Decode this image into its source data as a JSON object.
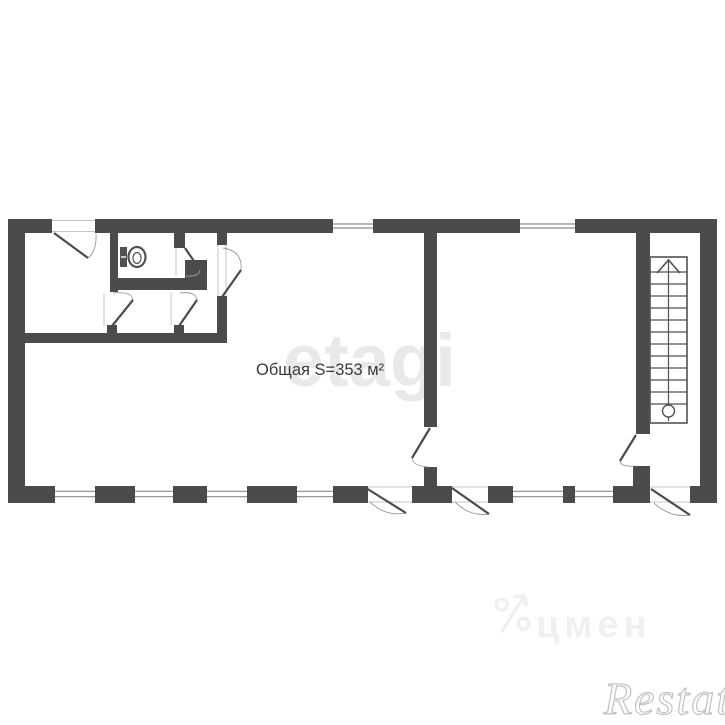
{
  "labels": {
    "area": "Общая S=353 м²"
  },
  "watermarks": {
    "etagi": "etagi",
    "cian": "цмен",
    "restate": "Restate"
  },
  "colors": {
    "wall": "#4b4b4b",
    "fixture": "#525252",
    "glazing": "#8c8c8c",
    "arc": "#9a9a9a",
    "thin": "#c4c4c4",
    "watermark_light": "#f0f0f0"
  },
  "plan": {
    "walls": [
      {
        "name": "top-wall-a",
        "r": [
          8,
          219,
          44,
          14
        ]
      },
      {
        "name": "top-wall-b",
        "r": [
          95,
          219,
          238,
          14
        ]
      },
      {
        "name": "top-wall-c",
        "r": [
          373,
          219,
          147,
          14
        ]
      },
      {
        "name": "top-wall-d",
        "r": [
          575,
          219,
          142,
          14
        ]
      },
      {
        "name": "left-wall",
        "r": [
          8,
          219,
          17,
          284
        ]
      },
      {
        "name": "right-wall",
        "r": [
          700,
          219,
          17,
          284
        ]
      },
      {
        "name": "bottom-wall-a",
        "r": [
          8,
          486,
          47,
          17
        ]
      },
      {
        "name": "bottom-wall-b",
        "r": [
          95,
          486,
          40,
          17
        ]
      },
      {
        "name": "bottom-wall-c",
        "r": [
          173,
          486,
          34,
          17
        ]
      },
      {
        "name": "bottom-wall-d",
        "r": [
          247,
          486,
          50,
          17
        ]
      },
      {
        "name": "bottom-wall-e",
        "r": [
          333,
          486,
          35,
          17
        ]
      },
      {
        "name": "bottom-wall-f",
        "r": [
          412,
          486,
          40,
          17
        ]
      },
      {
        "name": "bottom-wall-g",
        "r": [
          488,
          486,
          25,
          17
        ]
      },
      {
        "name": "bottom-wall-mullion",
        "r": [
          563,
          486,
          12,
          17
        ]
      },
      {
        "name": "bottom-wall-h",
        "r": [
          613,
          486,
          37,
          17
        ]
      },
      {
        "name": "bottom-wall-i",
        "r": [
          690,
          486,
          27,
          17
        ]
      },
      {
        "name": "middle-partition",
        "r": [
          424,
          233,
          13,
          194
        ]
      },
      {
        "name": "middle-partition-stub",
        "r": [
          424,
          467,
          13,
          19
        ]
      },
      {
        "name": "right-partition",
        "r": [
          636,
          233,
          14,
          201
        ]
      },
      {
        "name": "right-partition-stub",
        "r": [
          633,
          466,
          17,
          20
        ]
      },
      {
        "name": "toilet-left-wall",
        "r": [
          110,
          233,
          8,
          59
        ]
      },
      {
        "name": "toilet-bottom-wall",
        "r": [
          110,
          278,
          75,
          12
        ]
      },
      {
        "name": "toilet-right-stub",
        "r": [
          174,
          233,
          11,
          15
        ]
      },
      {
        "name": "cluster-mid-chunk",
        "r": [
          185,
          260,
          22,
          30
        ]
      },
      {
        "name": "cluster-right-stub-top",
        "r": [
          217,
          233,
          10,
          12
        ]
      },
      {
        "name": "cluster-right-wall",
        "r": [
          217,
          296,
          10,
          47
        ]
      },
      {
        "name": "corridor-wall",
        "r": [
          8,
          333,
          219,
          10
        ]
      },
      {
        "name": "corridor-stub-1",
        "r": [
          107,
          325,
          10,
          9
        ]
      },
      {
        "name": "corridor-stub-2",
        "r": [
          174,
          325,
          10,
          9
        ]
      }
    ],
    "windows": [
      {
        "name": "window-top-1",
        "r": [
          333,
          220,
          40,
          12
        ]
      },
      {
        "name": "window-top-2",
        "r": [
          520,
          220,
          55,
          12
        ]
      },
      {
        "name": "window-bottom-1",
        "r": [
          55,
          486,
          40,
          16
        ]
      },
      {
        "name": "window-bottom-2",
        "r": [
          135,
          486,
          38,
          16
        ]
      },
      {
        "name": "window-bottom-3",
        "r": [
          207,
          486,
          40,
          16
        ]
      },
      {
        "name": "window-bottom-4",
        "r": [
          297,
          486,
          36,
          16
        ]
      },
      {
        "name": "window-bottom-5",
        "r": [
          513,
          486,
          50,
          16
        ]
      },
      {
        "name": "window-bottom-6",
        "r": [
          575,
          486,
          38,
          16
        ]
      }
    ],
    "doors": [
      {
        "name": "entrance-door",
        "leaf": [
          54,
          233,
          88,
          258
        ],
        "arc": "M88,258 Q97,251 96,234"
      },
      {
        "name": "toilet-door",
        "leaf": [
          185,
          248,
          200,
          270
        ],
        "arc": "M200,270 Q199,277 186,276"
      },
      {
        "name": "hall-door",
        "leaf": [
          222,
          297,
          241,
          270
        ],
        "arc": "M241,270 Q243,251 223,248"
      },
      {
        "name": "corridor-door-1",
        "leaf": [
          112,
          326,
          133,
          300
        ],
        "arc": "M133,300 Q132,291 113,293"
      },
      {
        "name": "corridor-door-2",
        "leaf": [
          179,
          326,
          197,
          300
        ],
        "arc": "M197,300 Q196,291 180,293"
      },
      {
        "name": "mid-room-door",
        "leaf": [
          430,
          428,
          412,
          458
        ],
        "arc": "M412,458 Q413,466 428,467"
      },
      {
        "name": "stair-hall-door",
        "leaf": [
          636,
          435,
          620,
          461
        ],
        "arc": "M620,461 Q621,467 634,466"
      },
      {
        "name": "exit-door-1",
        "leaf": [
          366,
          488,
          406,
          513
        ],
        "arc": "M370,502 Q386,517 406,513"
      },
      {
        "name": "exit-door-2",
        "leaf": [
          452,
          488,
          489,
          514
        ],
        "arc": "M455,502 Q470,517 489,514"
      },
      {
        "name": "exit-door-3",
        "leaf": [
          651,
          489,
          690,
          515
        ],
        "arc": "M654,503 Q670,518 690,515"
      }
    ],
    "thin_lines": [
      [
        52,
        220.5,
        95,
        220.5
      ],
      [
        52,
        231.5,
        95,
        231.5
      ],
      [
        104,
        293,
        104,
        326
      ],
      [
        171,
        293,
        171,
        326
      ],
      [
        218,
        245,
        218,
        296
      ],
      [
        226,
        245,
        226,
        296
      ],
      [
        176,
        248,
        176,
        276
      ],
      [
        368,
        487,
        412,
        487
      ],
      [
        368,
        502,
        412,
        502
      ],
      [
        452,
        487,
        488,
        487
      ],
      [
        452,
        502,
        488,
        502
      ],
      [
        650,
        487,
        690,
        487
      ],
      [
        650,
        502,
        690,
        502
      ]
    ],
    "stairs": {
      "rect": [
        650,
        257,
        37,
        166
      ],
      "center_x": 668.5,
      "center_y1": 259,
      "center_y2": 421,
      "steps": 12,
      "steps_y1": 272,
      "steps_y2": 404,
      "arrow": [
        [
          657,
          273
        ],
        [
          668.5,
          260
        ],
        [
          680,
          273
        ]
      ],
      "circle": {
        "cx": 668.5,
        "cy": 411,
        "r": 6
      }
    },
    "toilet": {
      "tank": [
        120,
        247,
        7,
        20
      ],
      "slot": [
        121,
        257,
        126,
        257
      ],
      "bowl": {
        "cx": 137,
        "cy": 257,
        "rx": 8.5,
        "ry": 10
      },
      "inner": {
        "cx": 137,
        "cy": 258,
        "rx": 4,
        "ry": 5.5
      }
    }
  }
}
